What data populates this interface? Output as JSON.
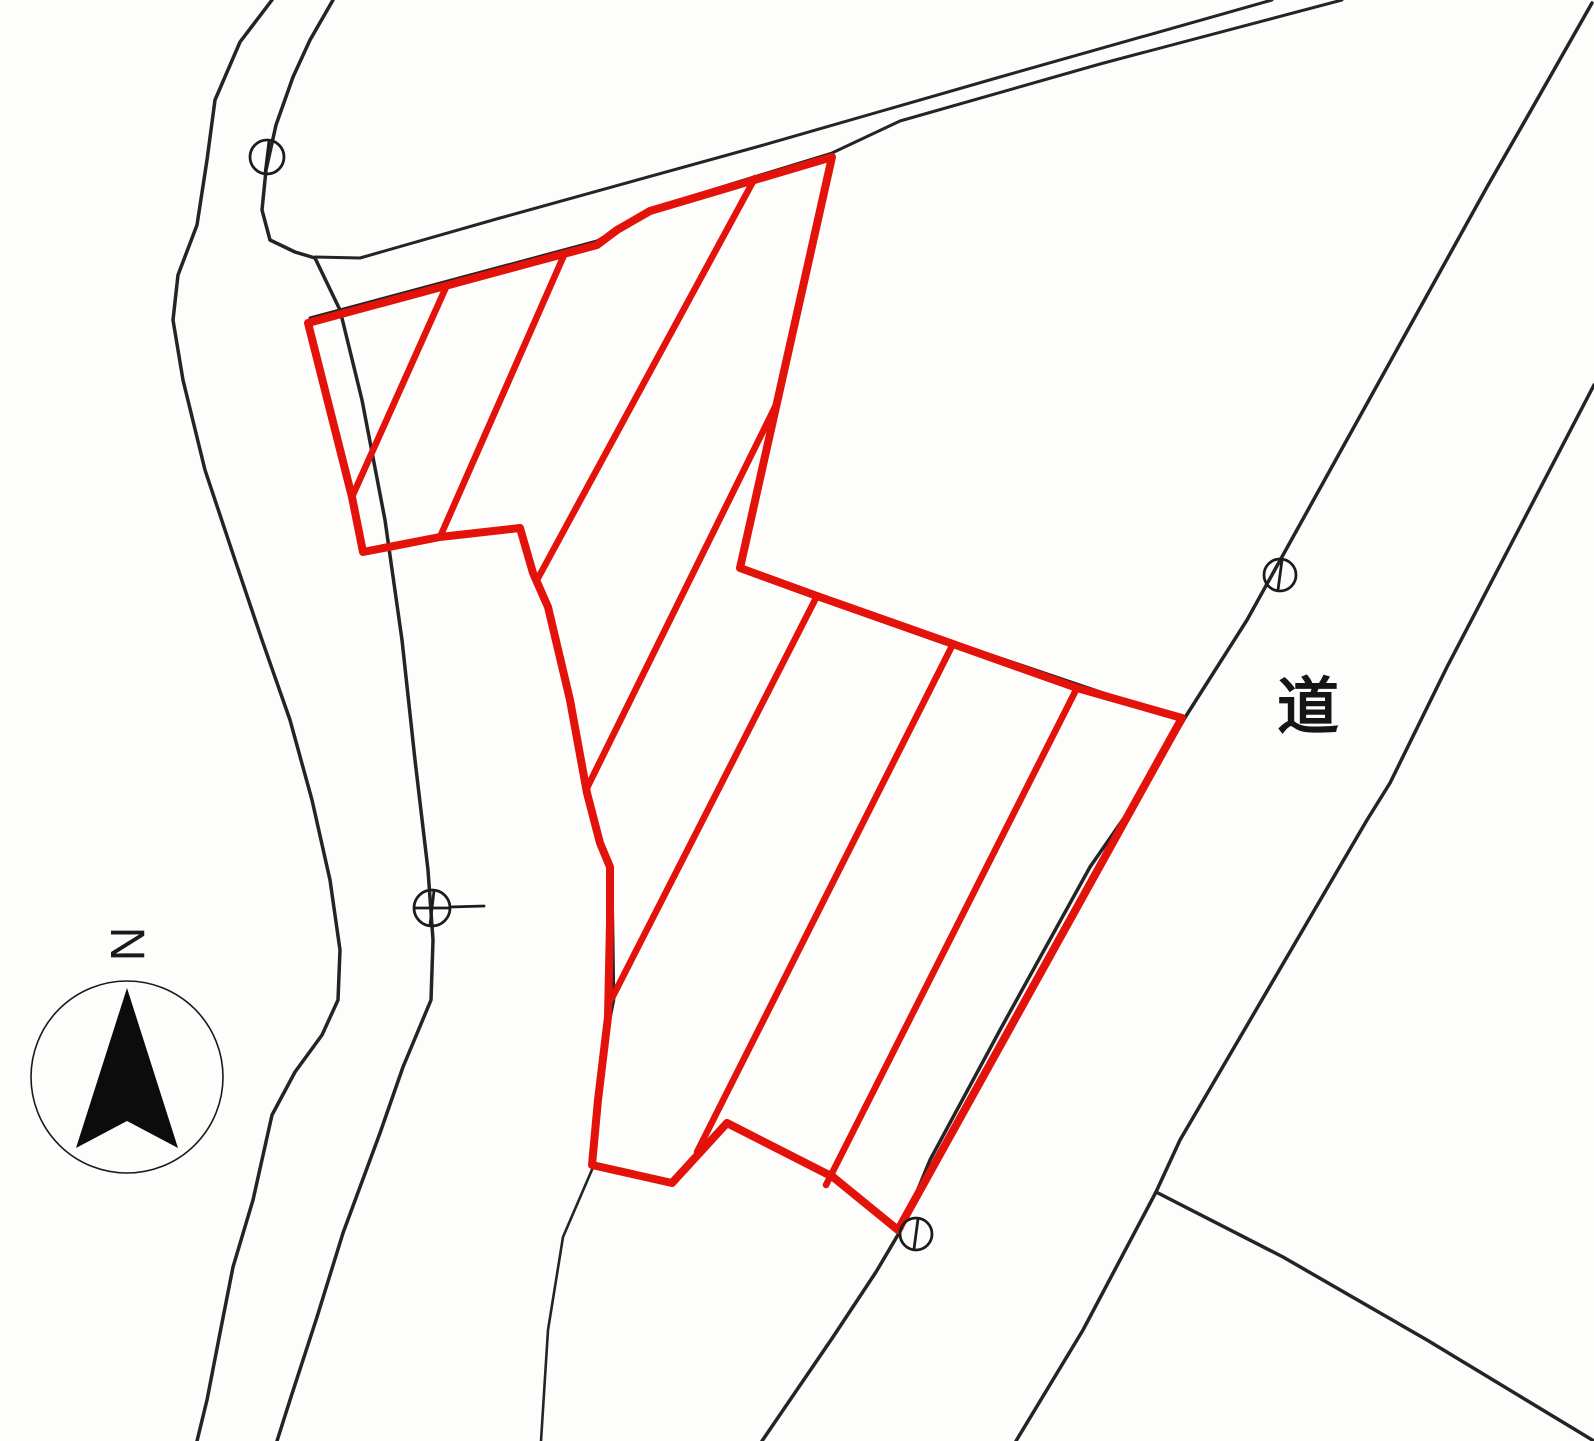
{
  "canvas": {
    "width": 1594,
    "height": 1441,
    "background": "#fdfdfc"
  },
  "colors": {
    "parcel_red": "#e3120b",
    "road_black": "#242424",
    "marker_black": "#1c1c1c"
  },
  "road_label": {
    "text": "道",
    "x": 1308,
    "y": 728,
    "font_size": 62
  },
  "compass": {
    "label": "N",
    "label_x": 127,
    "label_y": 960,
    "label_size": 48,
    "label_rotation": 90,
    "circle": {
      "cx": 127,
      "cy": 1077,
      "r": 96,
      "stroke_w": 1.6
    },
    "arrow_points": "127,988 76,1148 127,1121 178,1148"
  },
  "roads": [
    {
      "name": "left-road-outer-edge",
      "width": 3.5,
      "points": "272,0 240,42 215,100 207,160 197,225 178,275 173,320 183,380 205,470 235,560 262,640 290,720 312,800 330,880 340,950 338,1000 322,1035 295,1072 272,1115 253,1200 233,1267 220,1333 207,1400 197,1441"
    },
    {
      "name": "left-road-inner-edge",
      "width": 3.5,
      "points": "333,0 310,40 293,77 276,125 266,170 262,210 270,240 295,252 315,258 340,310 362,400 385,520 402,640 415,760 428,870 433,940 431,1000 403,1067 380,1133 343,1233 317,1317 290,1400 277,1441"
    },
    {
      "name": "top-road-upper-edge",
      "width": 3,
      "points": "315,257 360,258 500,218 760,146 1000,77 1272,0"
    },
    {
      "name": "top-road-lower-edge",
      "width": 3,
      "points": "310,318 597,241 650,209 832,153 900,121 1100,64 1342,0"
    },
    {
      "name": "right-road-left-edge",
      "width": 3.5,
      "points": "1592,3 1530,112 1487,187 1247,620 1186,716 1140,795 1090,867 1000,1030 930,1160 902,1228 876,1272 833,1337 762,1441"
    },
    {
      "name": "right-road-right-edge",
      "width": 3.5,
      "points": "1594,385 1447,667 1390,783 1367,820 1180,1140 1156,1192 1083,1330 1016,1441"
    },
    {
      "name": "right-road-branch-edge",
      "width": 3.5,
      "points": "1156,1192 1283,1257 1427,1340 1594,1441"
    },
    {
      "name": "mid-road-edge-under-parcel",
      "width": 2.6,
      "points": "522,532 535,575 550,612 572,703 589,795 602,845 612,870 613,925 614,1000 609,1025 600,1103 594,1165 563,1237 548,1330 541,1441"
    },
    {
      "name": "boundary-under-parcel-ne",
      "width": 2.6,
      "points": "741,570 1184,720"
    }
  ],
  "parcel": {
    "outline_points": "308,323 597,245 617,230 650,211 832,157 740,568 817,596 953,644 1077,688 1182,718 898,1230 833,1177 727,1123 672,1183 592,1165 598,1100 608,1017 610,923 610,867 600,843 587,793 570,700 548,607 533,573 520,528 440,537 363,552 352,497",
    "outline_width": 8,
    "hatch_width": 6.5,
    "hatches": [
      {
        "name": "hatch-line-1",
        "x1": 447,
        "y1": 285,
        "x2": 352,
        "y2": 497
      },
      {
        "name": "hatch-line-2",
        "x1": 565,
        "y1": 253,
        "x2": 440,
        "y2": 537
      },
      {
        "name": "hatch-line-3",
        "x1": 755,
        "y1": 178,
        "x2": 537,
        "y2": 580
      },
      {
        "name": "hatch-line-4",
        "x1": 775,
        "y1": 407,
        "x2": 586,
        "y2": 790
      },
      {
        "name": "hatch-line-5",
        "x1": 817,
        "y1": 596,
        "x2": 612,
        "y2": 998
      },
      {
        "name": "hatch-line-6",
        "x1": 953,
        "y1": 644,
        "x2": 697,
        "y2": 1152
      },
      {
        "name": "hatch-line-7",
        "x1": 1077,
        "y1": 688,
        "x2": 826,
        "y2": 1185
      }
    ]
  },
  "markers": [
    {
      "name": "survey-marker-top-left",
      "cx": 267,
      "cy": 157,
      "r": 17,
      "type": "vline"
    },
    {
      "name": "survey-marker-mid-left",
      "cx": 432,
      "cy": 908,
      "r": 18,
      "type": "cross",
      "tick_x2": 484
    },
    {
      "name": "survey-marker-right-road",
      "cx": 1280,
      "cy": 575,
      "r": 16,
      "type": "vline"
    },
    {
      "name": "survey-marker-bottom",
      "cx": 916,
      "cy": 1234,
      "r": 16,
      "type": "vline"
    }
  ]
}
